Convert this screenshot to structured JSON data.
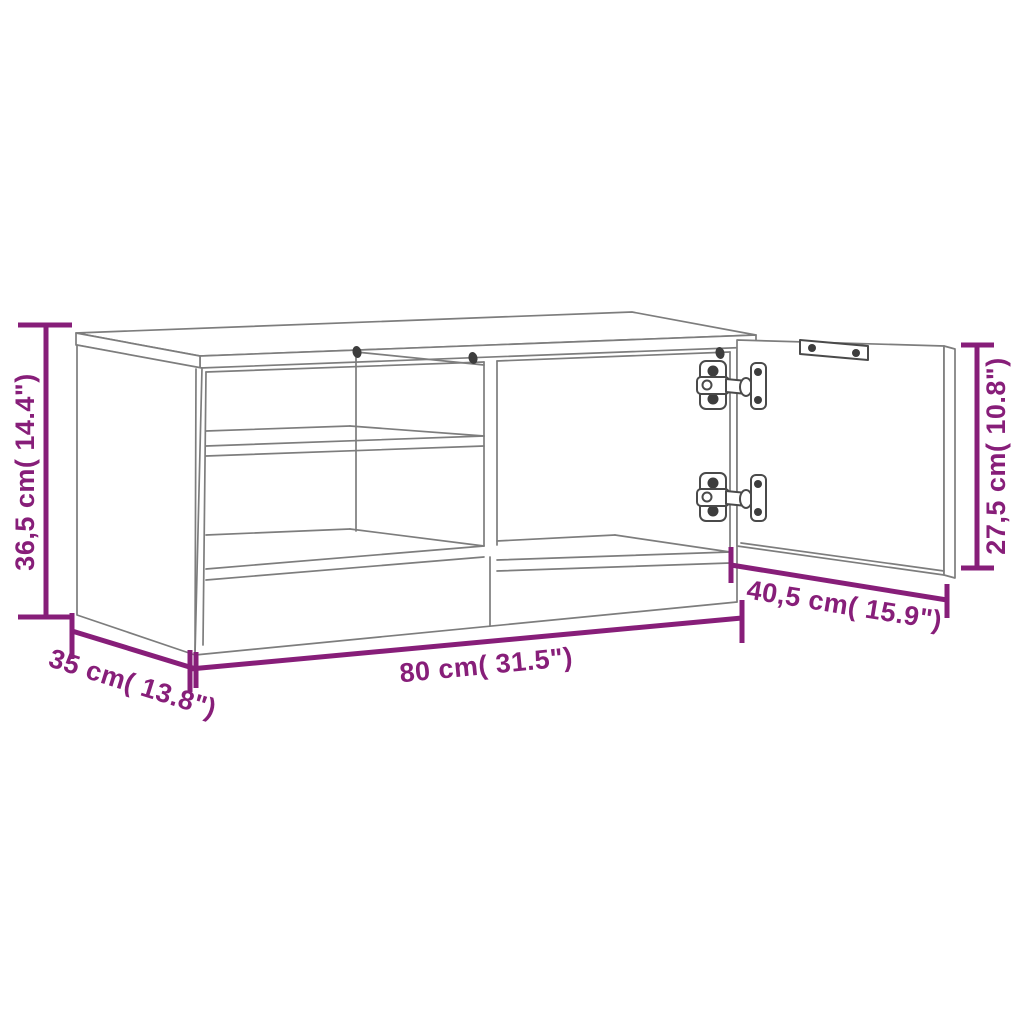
{
  "diagram": {
    "title": "TV cabinet dimension diagram",
    "style": {
      "background": "#ffffff",
      "outline_color": "#7d7d7d",
      "dimension_color": "#871e79",
      "screw_color": "#3d3d3d"
    },
    "dimensions": {
      "height": {
        "value_cm": "36,5",
        "value_in": "14.4",
        "label": "36,5 cm( 14.4\")"
      },
      "width": {
        "value_cm": "80",
        "value_in": "31.5",
        "label": "80 cm( 31.5\")"
      },
      "depth": {
        "value_cm": "35",
        "value_in": "13.8",
        "label": "35 cm( 13.8\")"
      },
      "door_width": {
        "value_cm": "40,5",
        "value_in": "15.9",
        "label": "40,5 cm( 15.9\")"
      },
      "door_height": {
        "value_cm": "27,5",
        "value_in": "10.8",
        "label": "27,5 cm( 10.8\")"
      }
    },
    "parts": {
      "cabinet": "TV cabinet with two open shelf compartments and one open door",
      "door_state": "open",
      "hinge_count": 2
    }
  }
}
